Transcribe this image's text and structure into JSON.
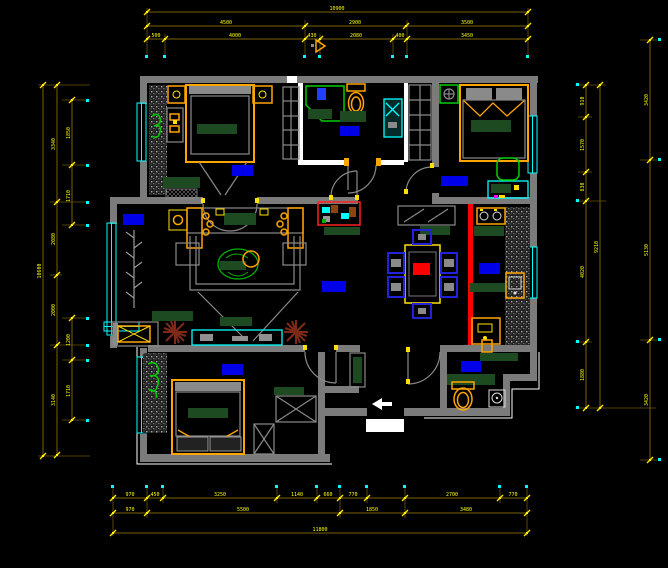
{
  "palette": {
    "background": "#000000",
    "wall_gray": "#7B7B7B",
    "partition_white": "#FFFFFF",
    "dimension_line": "#7A6200",
    "dimension_text": "#FFFF00",
    "window_cyan": "#00FFFF",
    "furniture_orange": "#FFA500",
    "furniture_dark_green": "#1D4A21",
    "plant_green": "#00CC00",
    "room_label_blue": "#0000E8",
    "feature_red": "#FF0000",
    "plant_brown": "#7E2A17",
    "chair_blue": "#2222DD"
  },
  "dimensions": {
    "top": {
      "row1": [
        "10900"
      ],
      "row2": [
        "4500",
        "2900",
        "3500"
      ],
      "row3": [
        "500",
        "4000",
        "430",
        "2080",
        "400",
        "3450"
      ]
    },
    "bottom": {
      "row1": [
        "970",
        "450",
        "3250",
        "1140",
        "660",
        "770",
        "1080",
        "2700",
        "770"
      ],
      "row2": [
        "970",
        "5500",
        "1850",
        "3480"
      ],
      "row3": [
        "11800"
      ]
    },
    "left": {
      "outer": [
        "10600"
      ],
      "mid": [
        "3340",
        "2080",
        "2000",
        "3140"
      ],
      "inner": [
        "1850",
        "1710",
        "1200",
        "1710"
      ]
    },
    "right": {
      "inner": [
        "910",
        "1570",
        "830",
        "4020",
        "1880"
      ],
      "mid": [
        "9210"
      ],
      "outer": [
        "3420",
        "5130",
        "3420"
      ]
    }
  }
}
